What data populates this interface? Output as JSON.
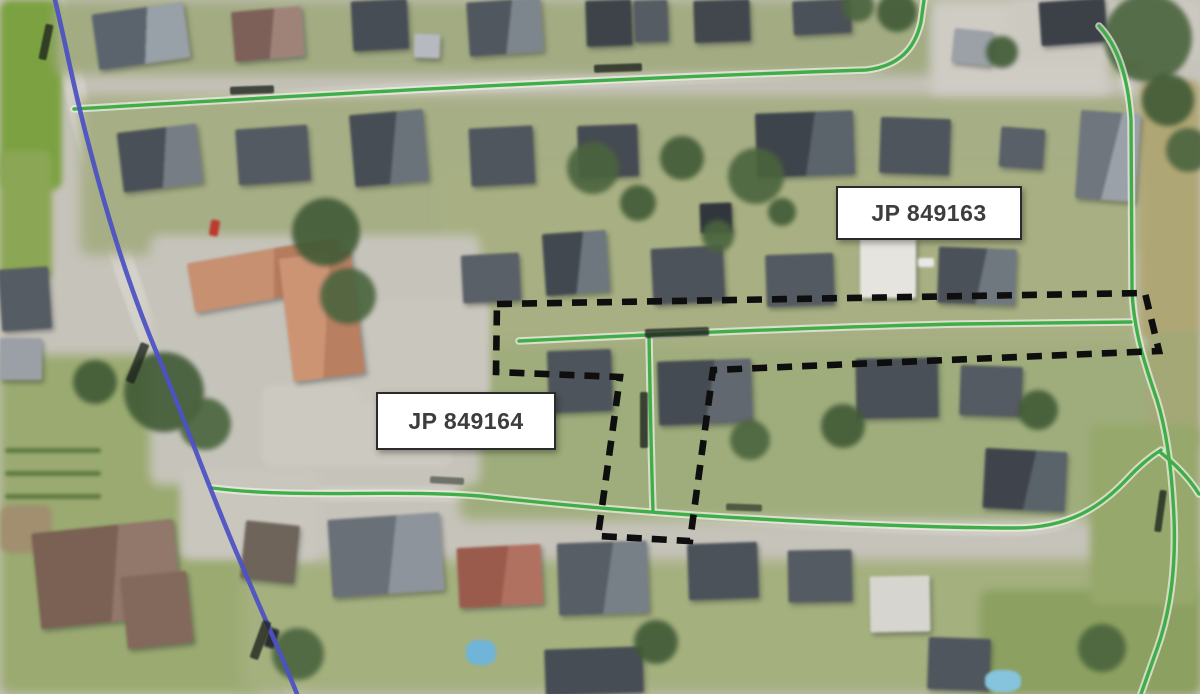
{
  "map_overlay": {
    "labels": [
      {
        "id": "jp-849163",
        "text": "JP 849163"
      },
      {
        "id": "jp-849164",
        "text": "JP 849164"
      }
    ],
    "colors": {
      "public_road_green": "#3fae49",
      "main_road_blue": "#4c52c4",
      "boundary_black": "#0e0e0e",
      "label_background": "#ffffff",
      "label_border": "#2b2b2b",
      "label_text": "#3d3d3d"
    }
  }
}
